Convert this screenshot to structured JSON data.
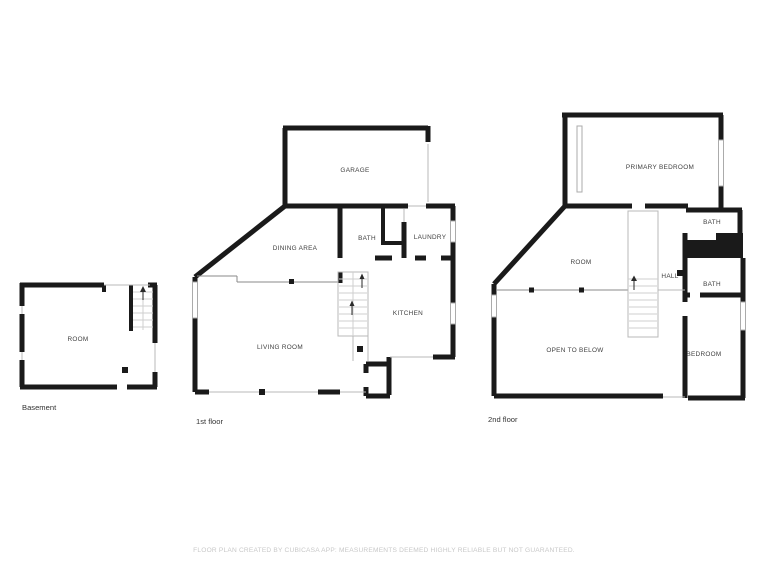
{
  "plans": {
    "basement": {
      "caption": "Basement",
      "rooms": {
        "room": "ROOM"
      }
    },
    "first_floor": {
      "caption": "1st floor",
      "rooms": {
        "garage": "GARAGE",
        "dining_area": "DINING AREA",
        "bath": "BATH",
        "laundry": "LAUNDRY",
        "kitchen": "KITCHEN",
        "living_room": "LIVING ROOM"
      }
    },
    "second_floor": {
      "caption": "2nd floor",
      "rooms": {
        "primary_bedroom": "PRIMARY BEDROOM",
        "bath_upper": "BATH",
        "room": "ROOM",
        "hall": "HALL",
        "bath_lower": "BATH",
        "open_to_below": "OPEN TO BELOW",
        "bedroom": "BEDROOM"
      }
    }
  },
  "footer": {
    "disclaimer": "FLOOR PLAN CREATED BY CUBICASA APP: MEASUREMENTS DEEMED HIGHLY RELIABLE BUT NOT GUARANTEED."
  },
  "colors": {
    "wall": "#1a1a1a",
    "thin_wall": "#b8b8b8",
    "stair_line": "#cfcfcf",
    "railing": "#8a8a8a",
    "room_label": "#404040",
    "caption": "#333333",
    "disclaimer": "#c8c8c8",
    "background": "#ffffff"
  }
}
